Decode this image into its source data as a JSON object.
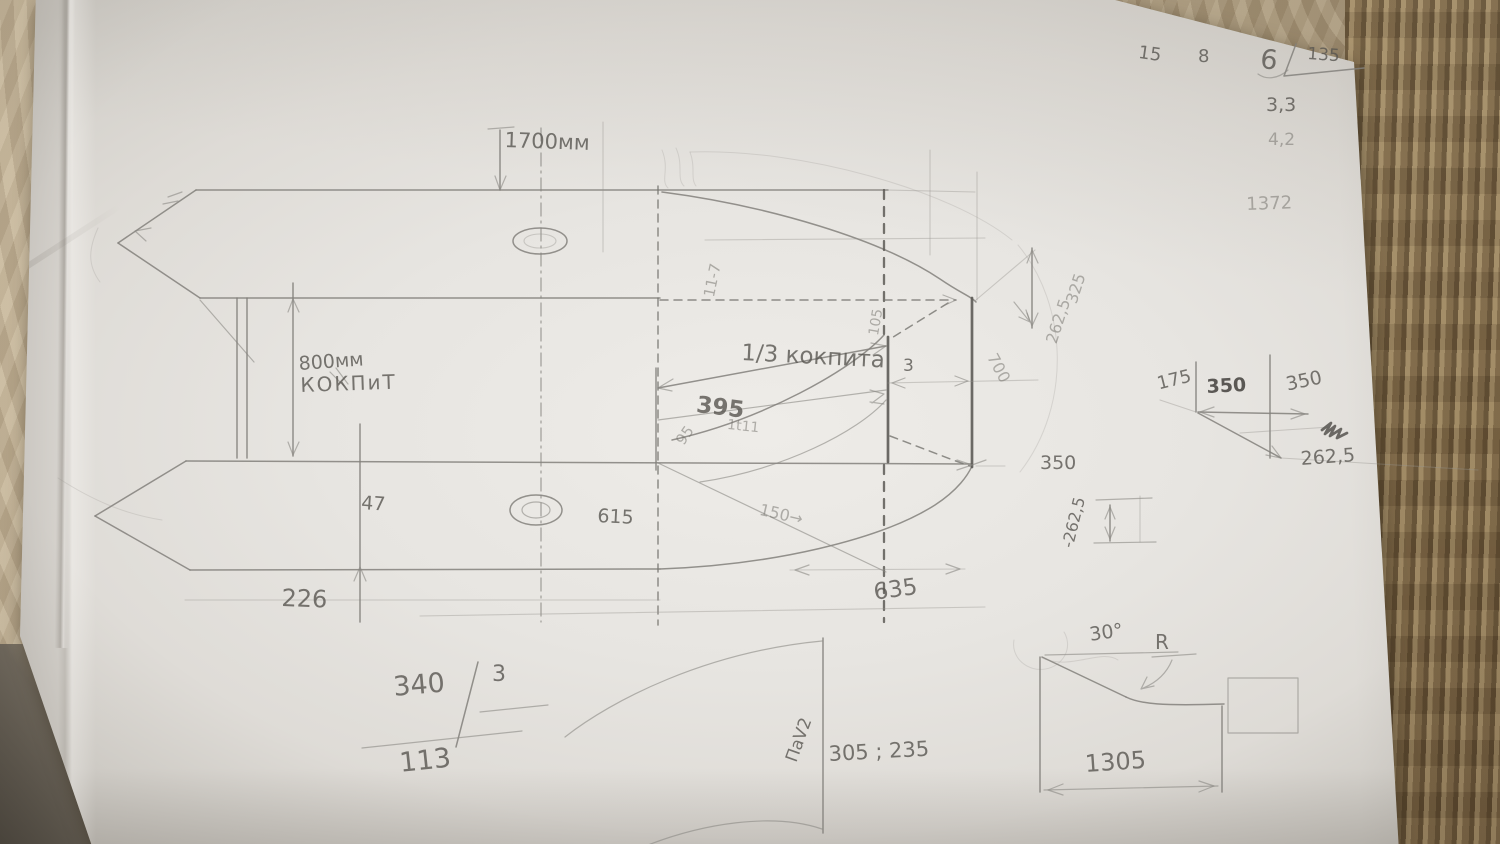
{
  "colors": {
    "paper": "#e9e7e3",
    "fabric_base": "#b2a287",
    "fabric_right_stripe": "#84704f",
    "pencil": "#5d5b56"
  },
  "labels": {
    "len_1700": "1700мм",
    "w_800": "800мм",
    "kokpit": "КОКПиТ",
    "third_kokpit": "1/3 кокпита",
    "d395": "395",
    "d1t11": "1t11",
    "d95": "95",
    "d105": "105",
    "d11_7": "11-7",
    "d3": "3",
    "d47": "47",
    "d615": "615",
    "d150": "150→",
    "d226": "226",
    "d635": "635",
    "d700": "700",
    "d262_5_diag": "262,5",
    "d325": "325",
    "d350_tip": "350",
    "dm262_5": "-262,5",
    "d175": "175",
    "d350_a": "350",
    "d350_b": "350",
    "d262_5_r": "262,5",
    "c340": "340",
    "c3": "3",
    "c113": "113",
    "pav2": "ПаV2",
    "d305_235": "305 ; 235",
    "a30": "30°",
    "rR": "R",
    "d1305": "1305",
    "n15": "15",
    "n8": "8",
    "n6": "6",
    "n135": "135",
    "n3_3": "3,3",
    "n4_2": "4,2",
    "n1372": "1372"
  }
}
